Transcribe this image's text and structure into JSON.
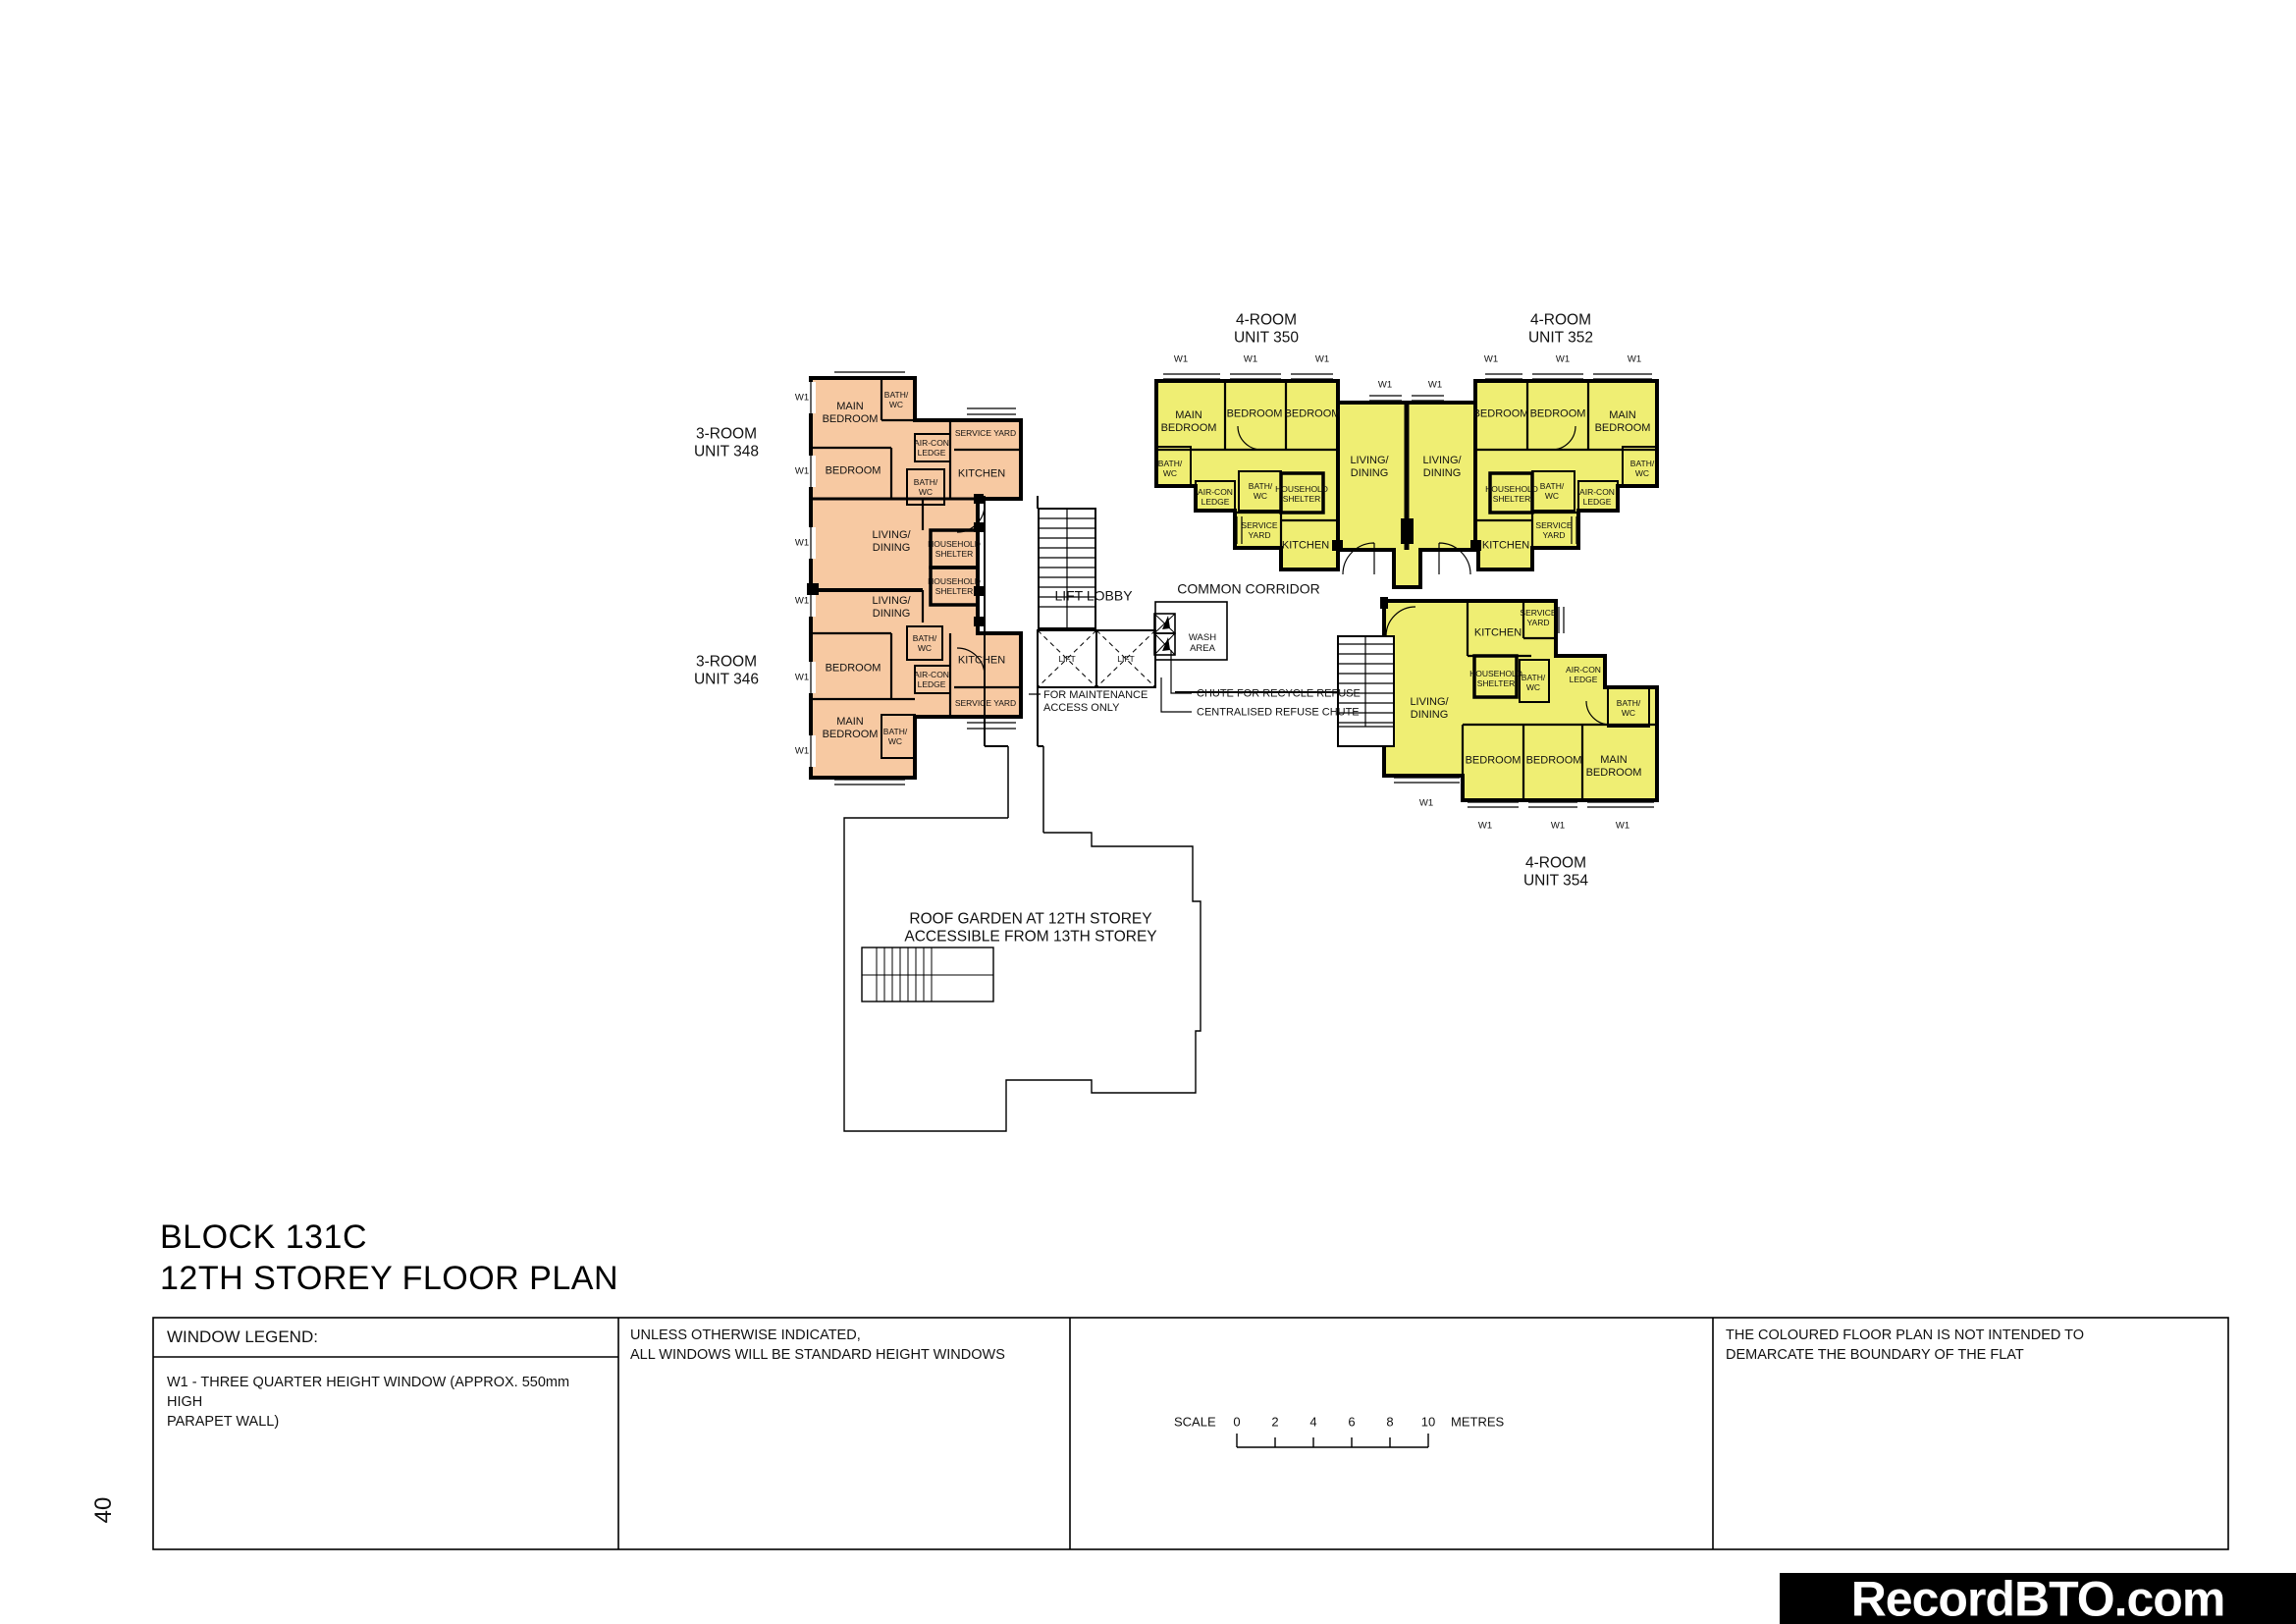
{
  "page": {
    "number": "40"
  },
  "title": {
    "line1": "BLOCK 131C",
    "line2": "12TH STOREY FLOOR PLAN"
  },
  "watermark": "RecordBTO.com",
  "legend": {
    "window_header": "WINDOW LEGEND:",
    "window_body": "W1 - THREE QUARTER HEIGHT WINDOW (APPROX. 550mm HIGH\nPARAPET WALL)",
    "windows_note": "UNLESS OTHERWISE INDICATED,\nALL WINDOWS WILL BE STANDARD HEIGHT WINDOWS",
    "scale": {
      "label": "SCALE",
      "ticks": [
        "0",
        "2",
        "4",
        "6",
        "8",
        "10"
      ],
      "unit": "METRES"
    },
    "disclaimer": "THE COLOURED FLOOR PLAN IS NOT INTENDED TO\nDEMARCATE THE BOUNDARY OF THE FLAT"
  },
  "plan": {
    "captions": {
      "u348": "3-ROOM\nUNIT 348",
      "u346": "3-ROOM\nUNIT 346",
      "u350": "4-ROOM\nUNIT 350",
      "u352": "4-ROOM\nUNIT 352",
      "u354": "4-ROOM\nUNIT 354"
    },
    "core": {
      "lift_lobby": "LIFT LOBBY",
      "common_corridor": "COMMON CORRIDOR",
      "wash_area": "WASH\nAREA",
      "lift": "LIFT",
      "maintenance": "FOR MAINTENANCE\nACCESS ONLY",
      "recycle_chute": "CHUTE FOR RECYCLE REFUSE",
      "refuse_chute": "CENTRALISED REFUSE CHUTE"
    },
    "roof_garden": "ROOF GARDEN AT 12TH STOREY\nACCESSIBLE FROM 13TH STOREY",
    "rooms": {
      "main_bedroom": "MAIN\nBEDROOM",
      "bedroom": "BEDROOM",
      "living_dining": "LIVING/\nDINING",
      "kitchen": "KITCHEN",
      "bath_wc": "BATH/\nWC",
      "service_yard": "SERVICE YARD",
      "service_yard2": "SERVICE\nYARD",
      "household_shelter": "HOUSEHOLD\nSHELTER",
      "aircon_ledge": "AIR-CON\nLEDGE",
      "w1": "W1"
    },
    "colors": {
      "three_room": "#F7C9A2",
      "four_room": "#EFEE73",
      "wall": "#000000"
    }
  }
}
